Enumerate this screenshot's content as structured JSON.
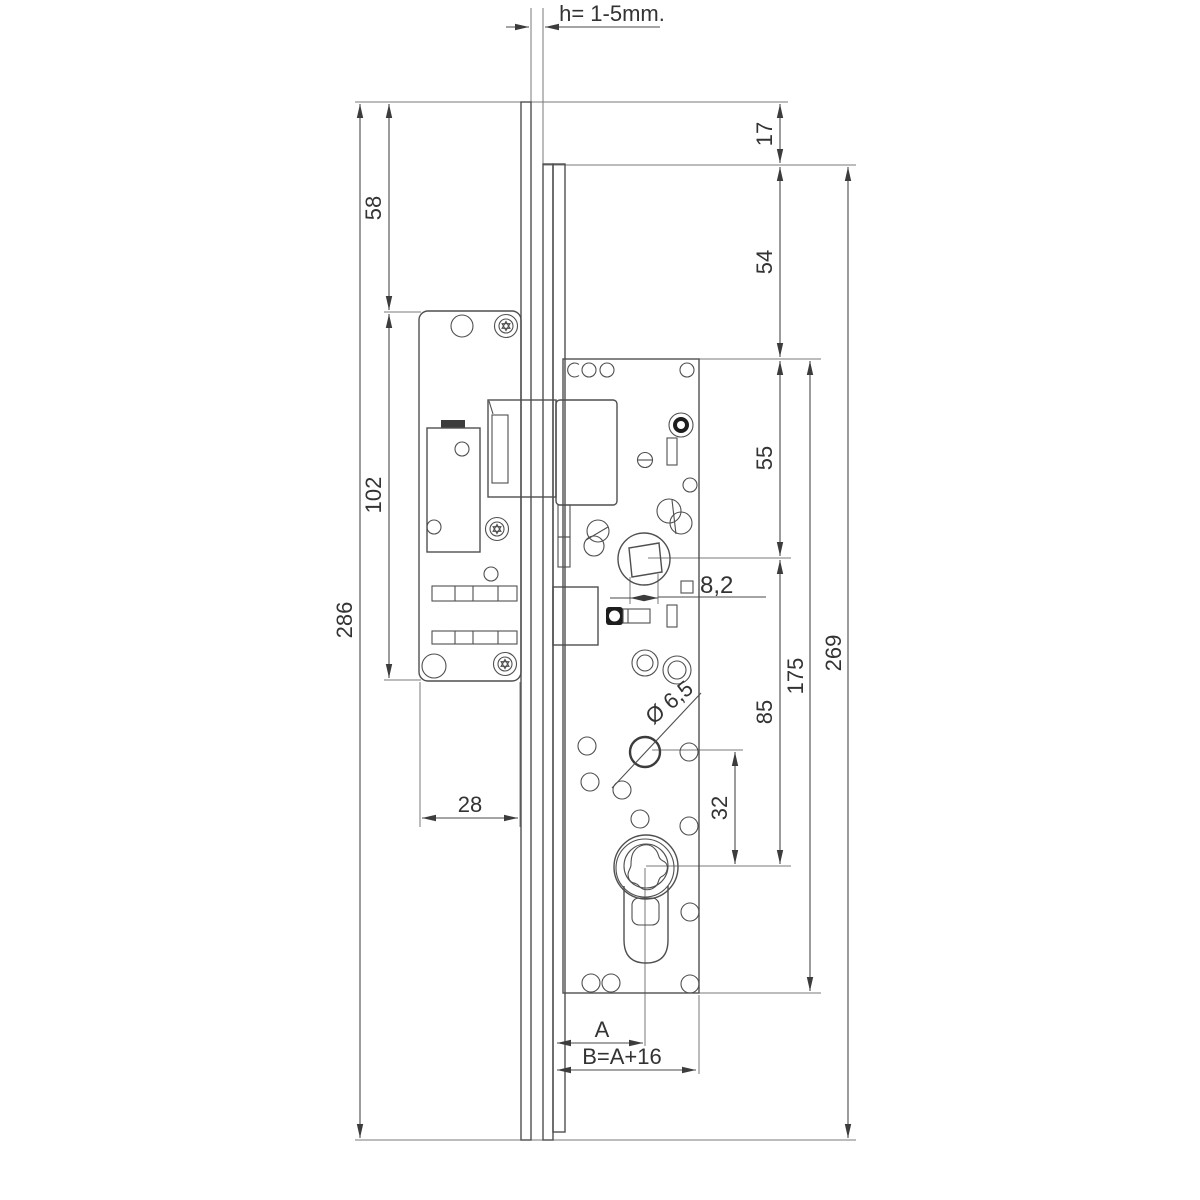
{
  "page": {
    "background": "#ffffff",
    "line_color": "#4f4f4f",
    "thin_line_color": "#7a7a7a",
    "text_color": "#333333"
  },
  "labels": {
    "h_gap": "h= 1-5mm.",
    "d17": "17",
    "d54": "54",
    "d55": "55",
    "d85": "85",
    "d32": "32",
    "d175": "175",
    "d269": "269",
    "d58": "58",
    "d102": "102",
    "d286": "286",
    "d28": "28",
    "square_8_2": "8,2",
    "dia_6_5": "Ø 6,5",
    "backset_a": "A",
    "b_formula": "B=A+16"
  }
}
